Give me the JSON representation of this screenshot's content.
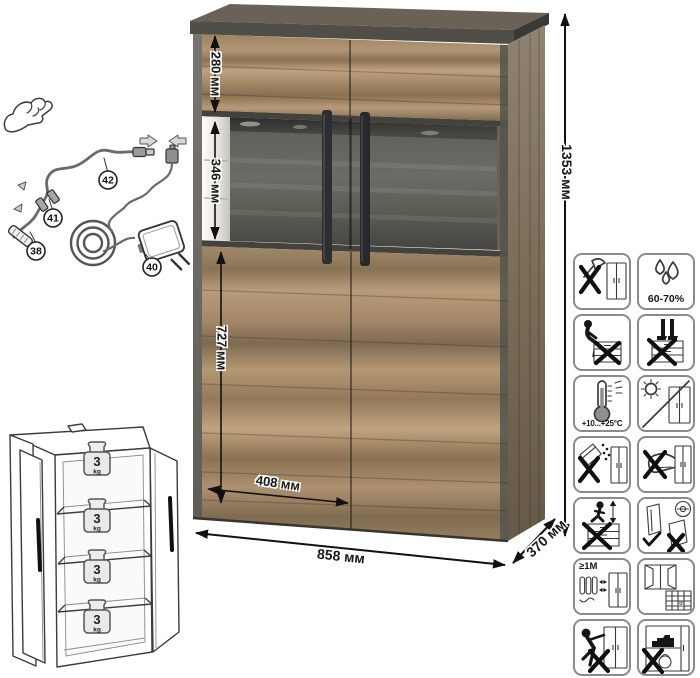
{
  "dimensions": {
    "height": "1353 мм",
    "top_section": "280 мм",
    "middle_section": "346 мм",
    "bottom_section": "727 мм",
    "door_width": "408 мм",
    "width": "858 мм",
    "depth": "370 мм"
  },
  "wiring_parts": {
    "cable": "42",
    "connector": "41",
    "led_strip": "38",
    "power_adapter": "40"
  },
  "shelf_load": {
    "value": "3",
    "unit": "kg"
  },
  "care": {
    "humidity": "60-70%",
    "temperature": "+10...+25°C",
    "heat_distance": "≥1M",
    "calendar_day": "21"
  },
  "colors": {
    "wood_light": "#b79a78",
    "wood_dark": "#8a7052",
    "frame_gray": "#514e48",
    "glass_panel": "#5c5d57",
    "handle_black": "#2c2e31",
    "annotation": "#111111",
    "icon_border": "#8b8b8b"
  }
}
